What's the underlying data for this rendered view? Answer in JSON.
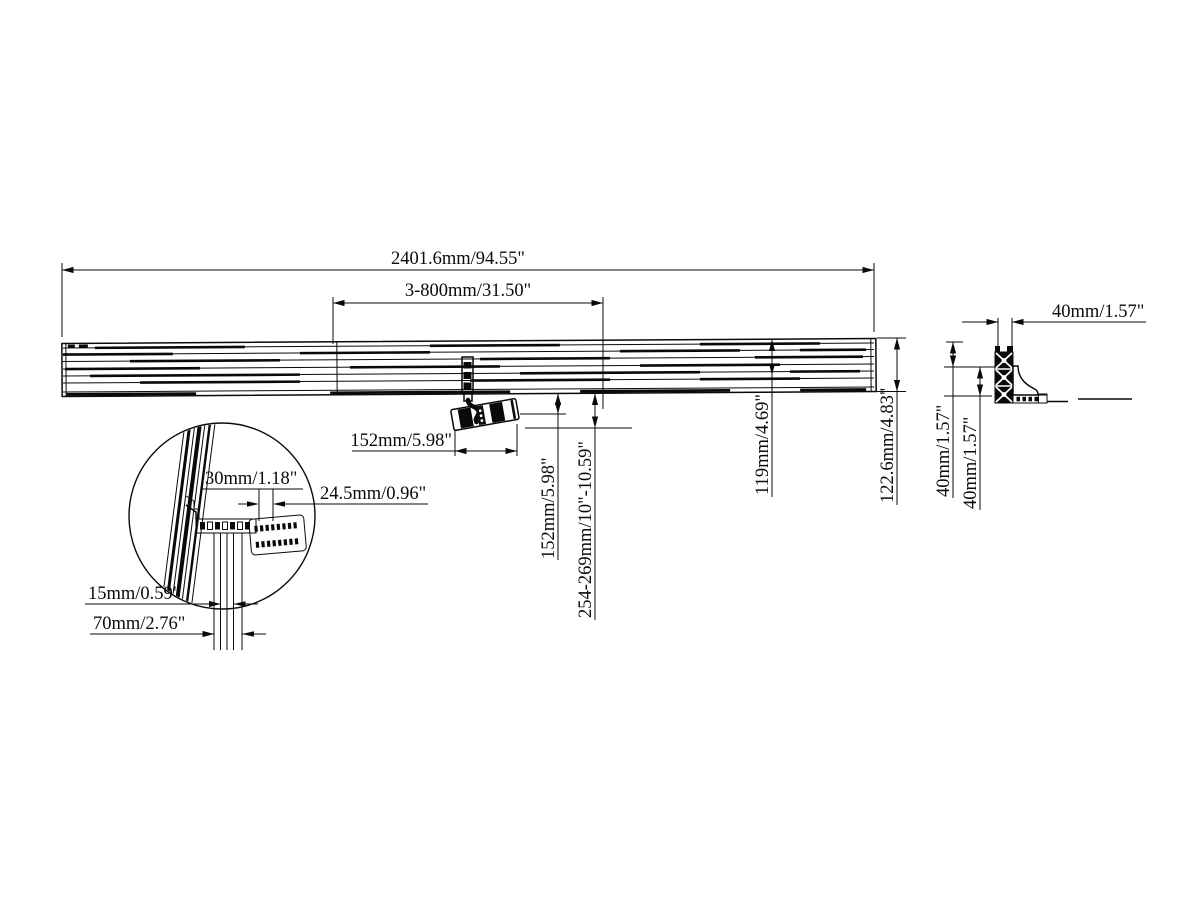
{
  "drawing": {
    "title": "Rail mount technical drawing",
    "dimensions": {
      "overall_length": "2401.6mm/94.55\"",
      "bracket_spacing": "3-800mm/31.50\"",
      "plate_width": "152mm/5.98\"",
      "drop_fixed": "152mm/5.98\"",
      "drop_range": "254-269mm/10\"-10.59\"",
      "rail_height_inner": "119mm/4.69\"",
      "rail_height_outer": "122.6mm/4.83\"",
      "profile_depth": "40mm/1.57\"",
      "profile_height_a": "40mm/1.57\"",
      "profile_height_b": "40mm/1.57\"",
      "hole_spacing": "30mm/1.18\"",
      "plate_thickness": "24.5mm/0.96\"",
      "strip_width": "15mm/0.59\"",
      "strip_offset": "70mm/2.76\""
    }
  }
}
